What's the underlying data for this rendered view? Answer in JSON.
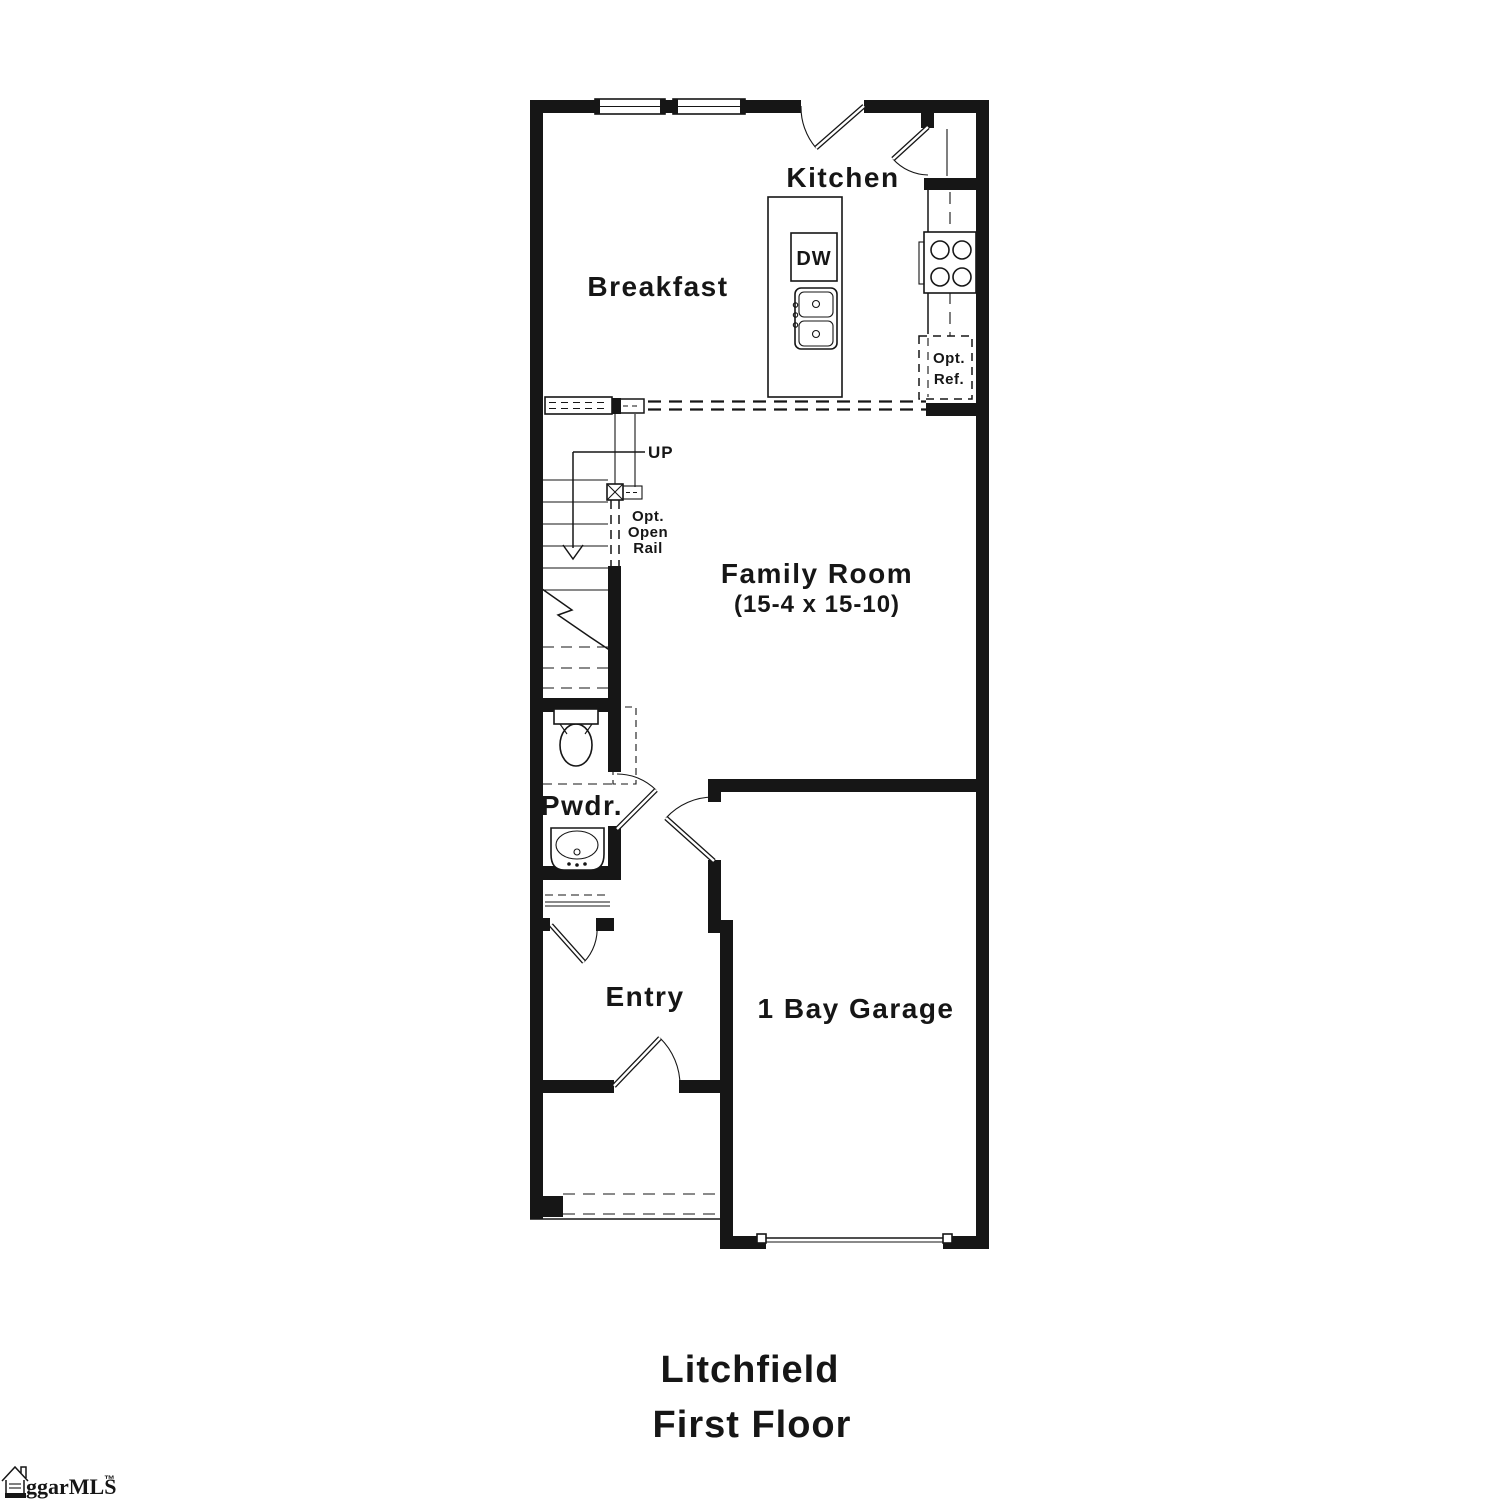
{
  "plan": {
    "rooms": {
      "kitchen": "Kitchen",
      "breakfast": "Breakfast",
      "family_room": "Family Room",
      "family_room_dimensions": "(15-4 x 15-10)",
      "powder": "Pwdr.",
      "entry": "Entry",
      "garage": "1 Bay Garage"
    },
    "stairs": {
      "direction": "UP",
      "rail_note": [
        "Opt.",
        "Open",
        "Rail"
      ]
    },
    "appliances": {
      "dishwasher": "DW",
      "optional_refrigerator": [
        "Opt.",
        "Ref."
      ]
    }
  },
  "title": {
    "plan_name": "Litchfield",
    "floor_name": "First Floor"
  },
  "watermark": {
    "text": "ggarMLS",
    "tm": "™"
  },
  "colors": {
    "line": "#161616",
    "background": "#ffffff"
  }
}
